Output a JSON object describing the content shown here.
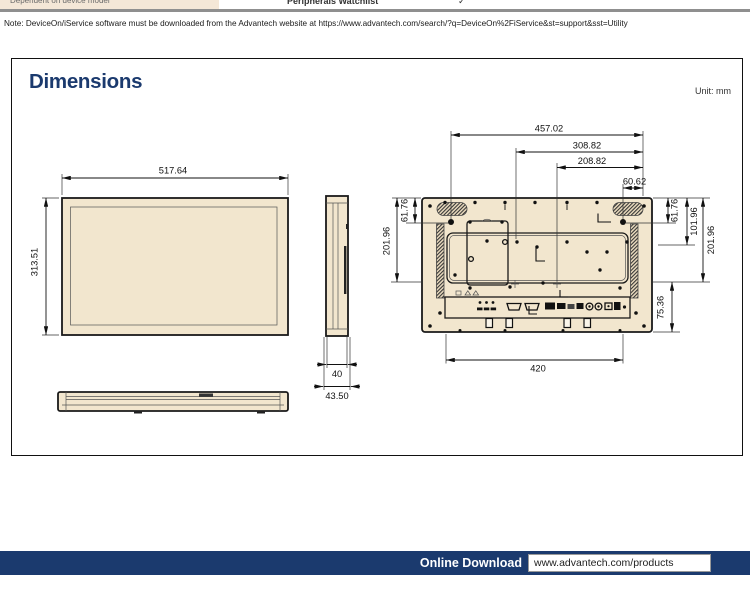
{
  "colors": {
    "navy": "#1B3A6E",
    "beige": "#F2E6CE",
    "rule_gray": "#8F8F8F"
  },
  "top_table": {
    "left_cell": "Dependent on device model",
    "right_cell": "Peripherals Watchlist",
    "check_mark": "✓"
  },
  "note": "Note: DeviceOn/iService software must be downloaded from the Advantech website at https://www.advantech.com/search/?q=DeviceOn%2FiService&st=support&sst=Utility",
  "section": {
    "title": "Dimensions",
    "unit": "Unit: mm"
  },
  "front_view": {
    "width": "517.64",
    "height": "313.51"
  },
  "side_view": {
    "body_depth": "40",
    "total_depth": "43.50"
  },
  "rear_view": {
    "top_width": "457.02",
    "mid_width": "308.82",
    "inner_width": "208.82",
    "corner_offset": "60.62",
    "left_top_offset": "61.76",
    "left_span": "201.96",
    "right_top_offset": "61.76",
    "right_mid_span": "101.96",
    "right_span": "201.96",
    "io_height": "75.36",
    "mount_width": "420"
  },
  "footer": {
    "label": "Online Download",
    "url": "www.advantech.com/products"
  }
}
